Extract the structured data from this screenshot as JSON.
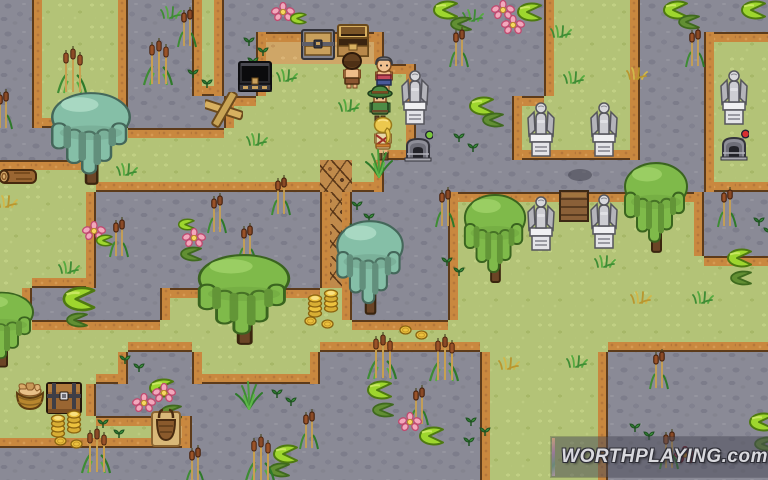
{
  "scene": {
    "name": "swamp-cemetery-map",
    "tile_size": 32,
    "cols": 24,
    "rows": 15
  },
  "palette": {
    "water": "#8a8a96",
    "water_stone": "#7d7d8b",
    "grass": "#b3c377",
    "dirt": "#cfa667",
    "twig_path": "#c08a4b",
    "shore_border": "#c9883f",
    "shore_outline": "#5d3b1a",
    "willow_teal": "#85bfa7",
    "willow_green": "#7fba4a",
    "statue_stone": "#cdcdd2",
    "coin_gold": "#ecc23e",
    "lilypad": "#9ed62e",
    "flower_pink": "#f2a8bc"
  },
  "tilemap": [
    "WGGGWWGWWWWWWWWWWGGGWWWW",
    "WGGGWWGWDDDDWWWWWGGGWWGG",
    "WGGGWWGWGGGGGWWWWGGGWWGG",
    "WGGGWWWGGGGGGWWWGGGGWWGG",
    "WWWGGGGGGGGGGWWWGGGGWWGG",
    "GGGGGGGGGGTGWWWWWWWWWWGG",
    "GGGWWWWWWWTWWWGGGGGGGGWW",
    "GGGWWWWWWWTWWWGGGGGGGGWW",
    "GGGWWWWWWWTWWWGGGGGGGGGG",
    "GWWWWGGGGGGWWWGGGGGGGGGG",
    "GGGGGGGGGGGGGGGGGGGGGGGG",
    "GGGGWWGGGGWWWWWGGGGWWWWW",
    "GGGWWWWWWWWWWWWGGGGWWWWW",
    "GGGGGDWWWWWWWWWGGGGWWWWW",
    "WWWWWWWWWWWWWWWGGGGWWWWW"
  ],
  "sprites": [
    {
      "type": "willow_teal",
      "x": 46,
      "y": 90,
      "w": 90,
      "h": 98
    },
    {
      "type": "willow_teal",
      "x": 332,
      "y": 218,
      "w": 76,
      "h": 100
    },
    {
      "type": "willow_green",
      "x": 192,
      "y": 252,
      "w": 104,
      "h": 96
    },
    {
      "type": "willow_green",
      "x": 460,
      "y": 192,
      "w": 70,
      "h": 94
    },
    {
      "type": "willow_green",
      "x": 620,
      "y": 160,
      "w": 72,
      "h": 96
    },
    {
      "type": "willow_green",
      "x": -34,
      "y": 290,
      "w": 72,
      "h": 80
    },
    {
      "type": "statue_angel",
      "x": 400,
      "y": 60
    },
    {
      "type": "statue_angel",
      "x": 719,
      "y": 60
    },
    {
      "type": "statue_angel",
      "x": 526,
      "y": 92
    },
    {
      "type": "statue_angel",
      "x": 589,
      "y": 92
    },
    {
      "type": "statue_angel",
      "x": 526,
      "y": 186
    },
    {
      "type": "statue_angel",
      "x": 589,
      "y": 184
    },
    {
      "type": "door_hatch",
      "x": 559,
      "y": 189
    },
    {
      "type": "shadow_blob",
      "x": 566,
      "y": 167
    },
    {
      "type": "machine_green",
      "x": 403,
      "y": 130
    },
    {
      "type": "machine_red",
      "x": 719,
      "y": 129
    },
    {
      "type": "chest_dark",
      "x": 237,
      "y": 58
    },
    {
      "type": "chest_gray",
      "x": 300,
      "y": 27
    },
    {
      "type": "chest_open",
      "x": 335,
      "y": 24
    },
    {
      "type": "chest_brown",
      "x": 45,
      "y": 380
    },
    {
      "type": "basket_bread",
      "x": 13,
      "y": 381
    },
    {
      "type": "basket_hamper",
      "x": 151,
      "y": 406
    },
    {
      "type": "log",
      "x": -4,
      "y": 165
    },
    {
      "type": "sign_cross",
      "x": 205,
      "y": 92
    },
    {
      "type": "char_brown",
      "x": 339,
      "y": 52
    },
    {
      "type": "char_gray",
      "x": 371,
      "y": 55
    },
    {
      "type": "char_green",
      "x": 366,
      "y": 84
    },
    {
      "type": "char_blonde",
      "x": 370,
      "y": 116
    },
    {
      "type": "coin_stack",
      "x": 50,
      "y": 412
    },
    {
      "type": "coin_stack",
      "x": 66,
      "y": 408
    },
    {
      "type": "coin_stack",
      "x": 307,
      "y": 292
    },
    {
      "type": "coin_stack",
      "x": 323,
      "y": 287
    },
    {
      "type": "coin",
      "x": 54,
      "y": 436
    },
    {
      "type": "coin",
      "x": 70,
      "y": 439
    },
    {
      "type": "coin",
      "x": 304,
      "y": 316
    },
    {
      "type": "coin",
      "x": 321,
      "y": 319
    },
    {
      "type": "coin",
      "x": 399,
      "y": 325
    },
    {
      "type": "coin",
      "x": 415,
      "y": 330
    },
    {
      "type": "cattail_cluster",
      "x": 56,
      "y": 44
    },
    {
      "type": "cattail_cluster",
      "x": 142,
      "y": 36
    },
    {
      "type": "cattail_cluster",
      "x": 366,
      "y": 330
    },
    {
      "type": "cattail_cluster",
      "x": 428,
      "y": 332
    },
    {
      "type": "cattail_cluster",
      "x": 80,
      "y": 424
    },
    {
      "type": "cattail_cluster",
      "x": 244,
      "y": 432
    },
    {
      "type": "cattail_pair",
      "x": 176,
      "y": 6
    },
    {
      "type": "cattail_pair",
      "x": -8,
      "y": 88
    },
    {
      "type": "cattail_pair",
      "x": 448,
      "y": 26
    },
    {
      "type": "cattail_pair",
      "x": 684,
      "y": 26
    },
    {
      "type": "cattail_pair",
      "x": 270,
      "y": 174
    },
    {
      "type": "cattail_pair",
      "x": 206,
      "y": 192
    },
    {
      "type": "cattail_pair",
      "x": 236,
      "y": 222
    },
    {
      "type": "cattail_pair",
      "x": 108,
      "y": 216
    },
    {
      "type": "cattail_pair",
      "x": 434,
      "y": 186
    },
    {
      "type": "cattail_pair",
      "x": 716,
      "y": 186
    },
    {
      "type": "cattail_pair",
      "x": 408,
      "y": 384
    },
    {
      "type": "cattail_pair",
      "x": 298,
      "y": 408
    },
    {
      "type": "cattail_pair",
      "x": 184,
      "y": 444
    },
    {
      "type": "cattail_pair",
      "x": 648,
      "y": 348
    },
    {
      "type": "cattail_pair",
      "x": 658,
      "y": 428
    },
    {
      "type": "reed_tuft",
      "x": 364,
      "y": 148
    },
    {
      "type": "reed_tuft",
      "x": 234,
      "y": 380
    },
    {
      "type": "tuft_green",
      "x": 160,
      "y": 5
    },
    {
      "type": "tuft_green",
      "x": 276,
      "y": 68
    },
    {
      "type": "tuft_green",
      "x": 338,
      "y": 98
    },
    {
      "type": "tuft_green",
      "x": 246,
      "y": 132
    },
    {
      "type": "tuft_green",
      "x": 550,
      "y": 24
    },
    {
      "type": "tuft_green",
      "x": 563,
      "y": 70
    },
    {
      "type": "tuft_green",
      "x": 116,
      "y": 162
    },
    {
      "type": "tuft_green",
      "x": 594,
      "y": 254
    },
    {
      "type": "tuft_green",
      "x": 692,
      "y": 290
    },
    {
      "type": "tuft_green",
      "x": 566,
      "y": 354
    },
    {
      "type": "tuft_green",
      "x": 58,
      "y": 260
    },
    {
      "type": "tuft_green",
      "x": 462,
      "y": 8
    },
    {
      "type": "tuft_yellow",
      "x": 626,
      "y": 66
    },
    {
      "type": "tuft_yellow",
      "x": 630,
      "y": 290
    },
    {
      "type": "tuft_yellow",
      "x": -4,
      "y": 194
    },
    {
      "type": "tuft_yellow",
      "x": 498,
      "y": 356
    },
    {
      "type": "sprout",
      "x": 242,
      "y": 36
    },
    {
      "type": "sprout",
      "x": 256,
      "y": 46
    },
    {
      "type": "sprout",
      "x": 246,
      "y": 56
    },
    {
      "type": "sprout",
      "x": 350,
      "y": 200
    },
    {
      "type": "sprout",
      "x": 362,
      "y": 212
    },
    {
      "type": "sprout",
      "x": 348,
      "y": 222
    },
    {
      "type": "sprout",
      "x": 452,
      "y": 132
    },
    {
      "type": "sprout",
      "x": 466,
      "y": 142
    },
    {
      "type": "sprout",
      "x": 440,
      "y": 256
    },
    {
      "type": "sprout",
      "x": 452,
      "y": 266
    },
    {
      "type": "sprout",
      "x": 752,
      "y": 216
    },
    {
      "type": "sprout",
      "x": 762,
      "y": 226
    },
    {
      "type": "sprout",
      "x": 464,
      "y": 416
    },
    {
      "type": "sprout",
      "x": 478,
      "y": 426
    },
    {
      "type": "sprout",
      "x": 462,
      "y": 436
    },
    {
      "type": "sprout",
      "x": 96,
      "y": 418
    },
    {
      "type": "sprout",
      "x": 112,
      "y": 428
    },
    {
      "type": "sprout",
      "x": 118,
      "y": 354
    },
    {
      "type": "sprout",
      "x": 132,
      "y": 362
    },
    {
      "type": "sprout",
      "x": 270,
      "y": 388
    },
    {
      "type": "sprout",
      "x": 284,
      "y": 396
    },
    {
      "type": "sprout",
      "x": 628,
      "y": 422
    },
    {
      "type": "sprout",
      "x": 642,
      "y": 430
    },
    {
      "type": "sprout",
      "x": 186,
      "y": 68
    },
    {
      "type": "sprout",
      "x": 200,
      "y": 78
    },
    {
      "type": "lilypad",
      "x": 428,
      "y": 0
    },
    {
      "type": "lilypad",
      "x": 658,
      "y": 0
    },
    {
      "type": "lilypad",
      "x": 736,
      "y": 0
    },
    {
      "type": "lilypad",
      "x": 464,
      "y": 96
    },
    {
      "type": "lilypad",
      "x": 512,
      "y": 2
    },
    {
      "type": "lilypad",
      "x": 722,
      "y": 248
    },
    {
      "type": "lilypad",
      "x": 144,
      "y": 378
    },
    {
      "type": "lilypad",
      "x": 362,
      "y": 380
    },
    {
      "type": "lilypad",
      "x": 414,
      "y": 426
    },
    {
      "type": "lilypad",
      "x": 268,
      "y": 444
    },
    {
      "type": "lilypad",
      "x": 744,
      "y": 412
    },
    {
      "type": "lilypad",
      "x": 56,
      "y": 286,
      "w": 42,
      "h": 26
    },
    {
      "type": "lilypad_dark",
      "x": 444,
      "y": 16
    },
    {
      "type": "lilypad_dark",
      "x": 672,
      "y": 14
    },
    {
      "type": "lilypad_dark",
      "x": 476,
      "y": 112
    },
    {
      "type": "lilypad_dark",
      "x": 724,
      "y": 270
    },
    {
      "type": "lilypad_dark",
      "x": 60,
      "y": 312
    },
    {
      "type": "lilypad_dark",
      "x": 174,
      "y": 246
    },
    {
      "type": "lilypad_dark",
      "x": 366,
      "y": 402
    },
    {
      "type": "lilypad_dark",
      "x": 262,
      "y": 462
    },
    {
      "type": "lilypad_dark",
      "x": 748,
      "y": 436
    },
    {
      "type": "lilypad_dark",
      "x": 154,
      "y": 404
    },
    {
      "type": "lilypad_small",
      "x": 288,
      "y": 12
    },
    {
      "type": "lilypad_small",
      "x": 94,
      "y": 234
    },
    {
      "type": "lilypad_small",
      "x": 176,
      "y": 218
    },
    {
      "type": "flower_pink",
      "x": 271,
      "y": 2
    },
    {
      "type": "flower_pink",
      "x": 491,
      "y": 0
    },
    {
      "type": "flower_pink",
      "x": 501,
      "y": 15
    },
    {
      "type": "flower_pink",
      "x": 182,
      "y": 228
    },
    {
      "type": "flower_pink",
      "x": 82,
      "y": 221
    },
    {
      "type": "flower_pink",
      "x": 152,
      "y": 383
    },
    {
      "type": "flower_pink",
      "x": 132,
      "y": 393
    },
    {
      "type": "flower_pink",
      "x": 398,
      "y": 412
    },
    {
      "type": "flower_red",
      "x": 674,
      "y": 446
    }
  ],
  "watermark": {
    "text": "WORTHPLAYING.com",
    "x": 551,
    "y": 437,
    "width": 217,
    "height": 40
  }
}
